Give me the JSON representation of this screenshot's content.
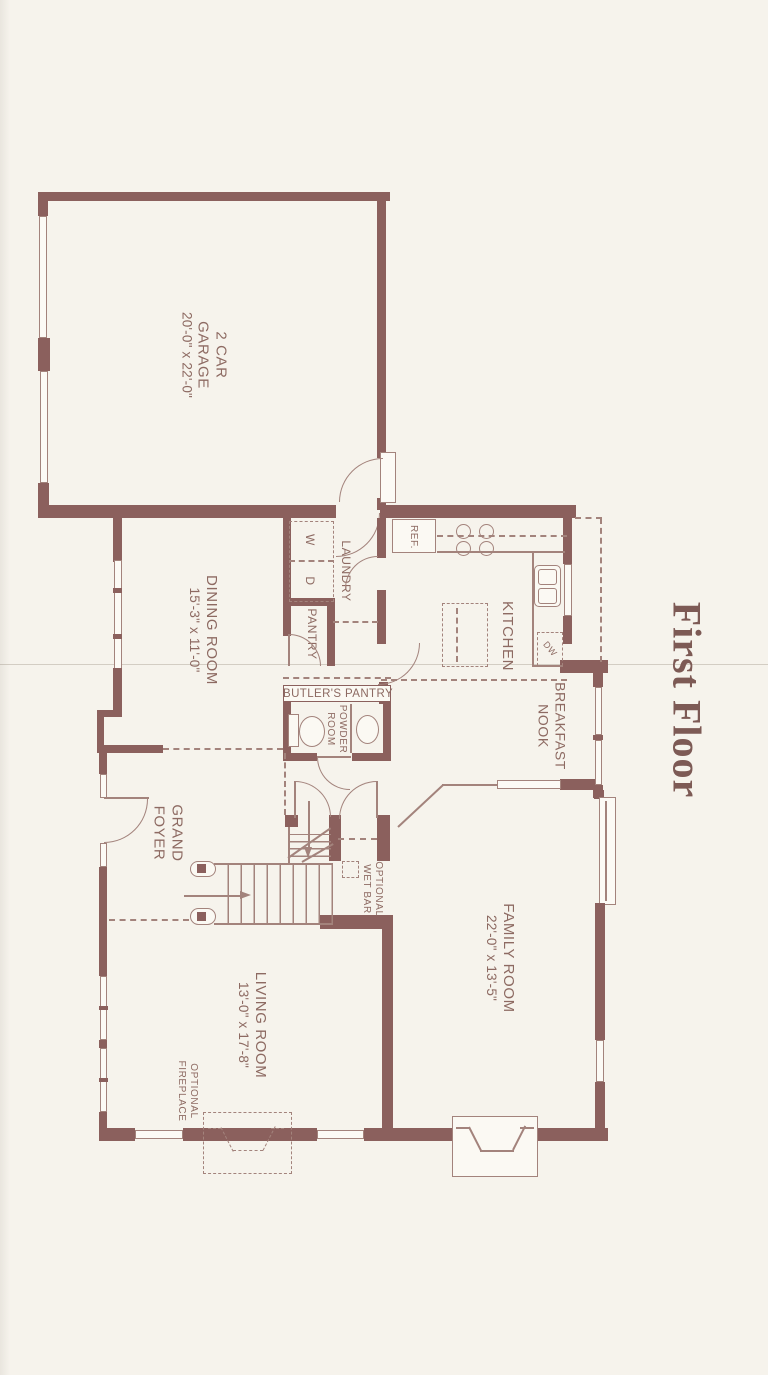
{
  "title": "First Floor",
  "rooms": {
    "garage": {
      "line1": "2 CAR",
      "line2": "GARAGE",
      "dims": "20'-0\" x 22'-0\""
    },
    "dining": {
      "name": "DINING ROOM",
      "dims": "15'-3\" x 11'-0\""
    },
    "kitchen": {
      "name": "KITCHEN"
    },
    "laundry": {
      "name": "LAUNDRY"
    },
    "pantry": {
      "name": "PANTRY"
    },
    "butlers": {
      "name": "BUTLER'S PANTRY"
    },
    "powder": {
      "line1": "POWDER",
      "line2": "ROOM"
    },
    "breakfast": {
      "line1": "BREAKFAST",
      "line2": "NOOK"
    },
    "foyer": {
      "line1": "GRAND",
      "line2": "FOYER"
    },
    "living": {
      "name": "LIVING ROOM",
      "dims": "13'-0\" x 17'-8\""
    },
    "family": {
      "name": "FAMILY ROOM",
      "dims": "22'-0\" x 13'-5\""
    },
    "wetbar": {
      "line1": "OPTIONAL",
      "line2": "WET BAR"
    },
    "fireplace": {
      "line1": "OPTIONAL",
      "line2": "FIREPLACE"
    }
  },
  "appliances": {
    "washer": "W",
    "dryer": "D",
    "fridge": "REF.",
    "dishwasher": "DW"
  },
  "colors": {
    "wall": "#8b605d",
    "line": "#a3837c",
    "text": "#8d6a62",
    "paper": "#f6f3ec"
  }
}
